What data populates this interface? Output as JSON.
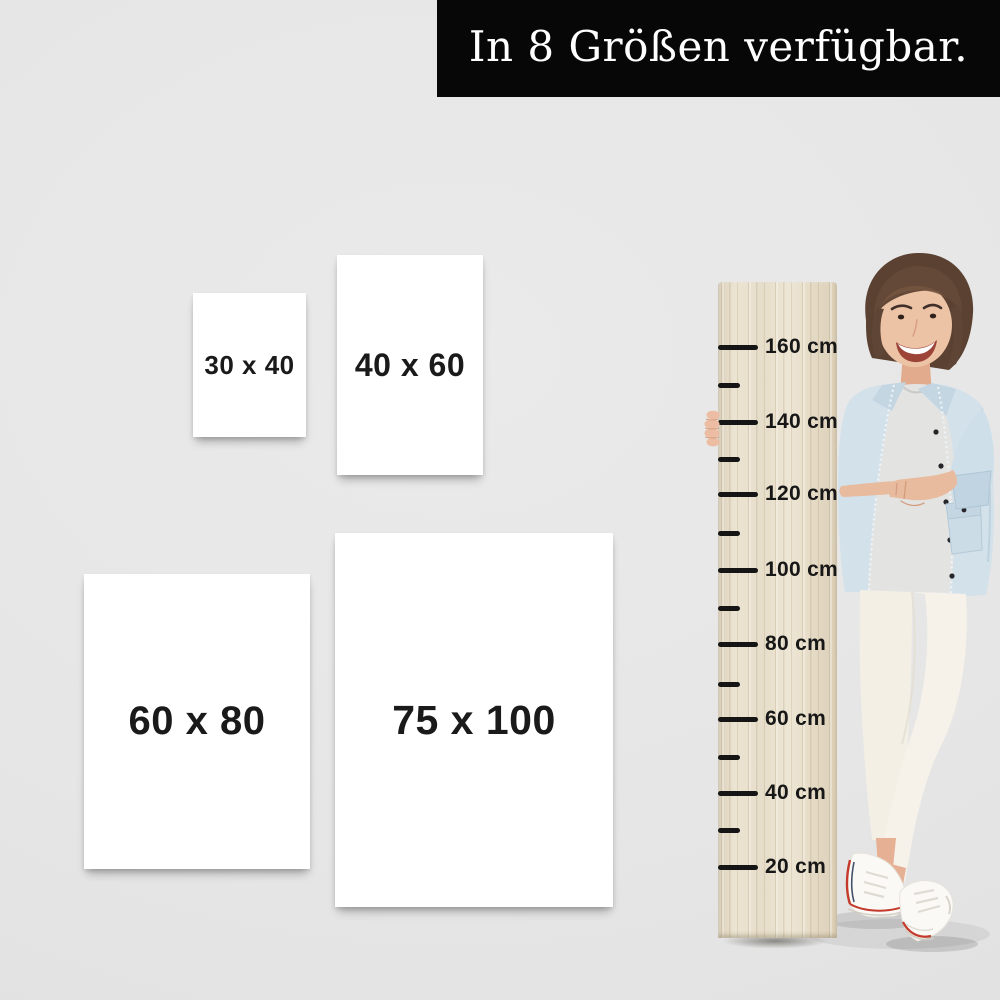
{
  "banner": {
    "text": "In 8 Größen verfügbar.",
    "bg_color": "#070707",
    "text_color": "#ffffff"
  },
  "sizes": [
    {
      "label": "30 x 40",
      "width_cm": 30,
      "height_cm": 40
    },
    {
      "label": "40 x 60",
      "width_cm": 40,
      "height_cm": 60
    },
    {
      "label": "60 x 80",
      "width_cm": 60,
      "height_cm": 80
    },
    {
      "label": "75 x 100",
      "width_cm": 75,
      "height_cm": 100
    }
  ],
  "ruler": {
    "unit": "cm",
    "marks": [
      {
        "value": 160,
        "label": "160 cm"
      },
      {
        "value": 140,
        "label": "140 cm"
      },
      {
        "value": 120,
        "label": "120 cm"
      },
      {
        "value": 100,
        "label": "100 cm"
      },
      {
        "value": 80,
        "label": "80 cm"
      },
      {
        "value": 60,
        "label": "60 cm"
      },
      {
        "value": 40,
        "label": "40 cm"
      },
      {
        "value": 20,
        "label": "20 cm"
      }
    ],
    "minor_marks": [
      150,
      130,
      110,
      90,
      70,
      50,
      30
    ]
  },
  "person": {
    "description": "Smiling woman with short brown hair wearing a light denim jacket, white t-shirt, white pants and white sneakers, holding the wooden measuring board and pointing at the 120 cm mark"
  },
  "colors": {
    "background": "#e6e6e6",
    "card": "#ffffff",
    "card_text": "#1a1a1a",
    "wood_light": "#ece4d2",
    "wood_dark": "#d9cdb6",
    "tick": "#151515",
    "denim": "#d3e1ea",
    "tshirt": "#e3e3e2",
    "pants": "#f3efe5",
    "skin": "#e9bb9e",
    "hair": "#5a4132",
    "shoe_stripe": "#c33a2b"
  }
}
